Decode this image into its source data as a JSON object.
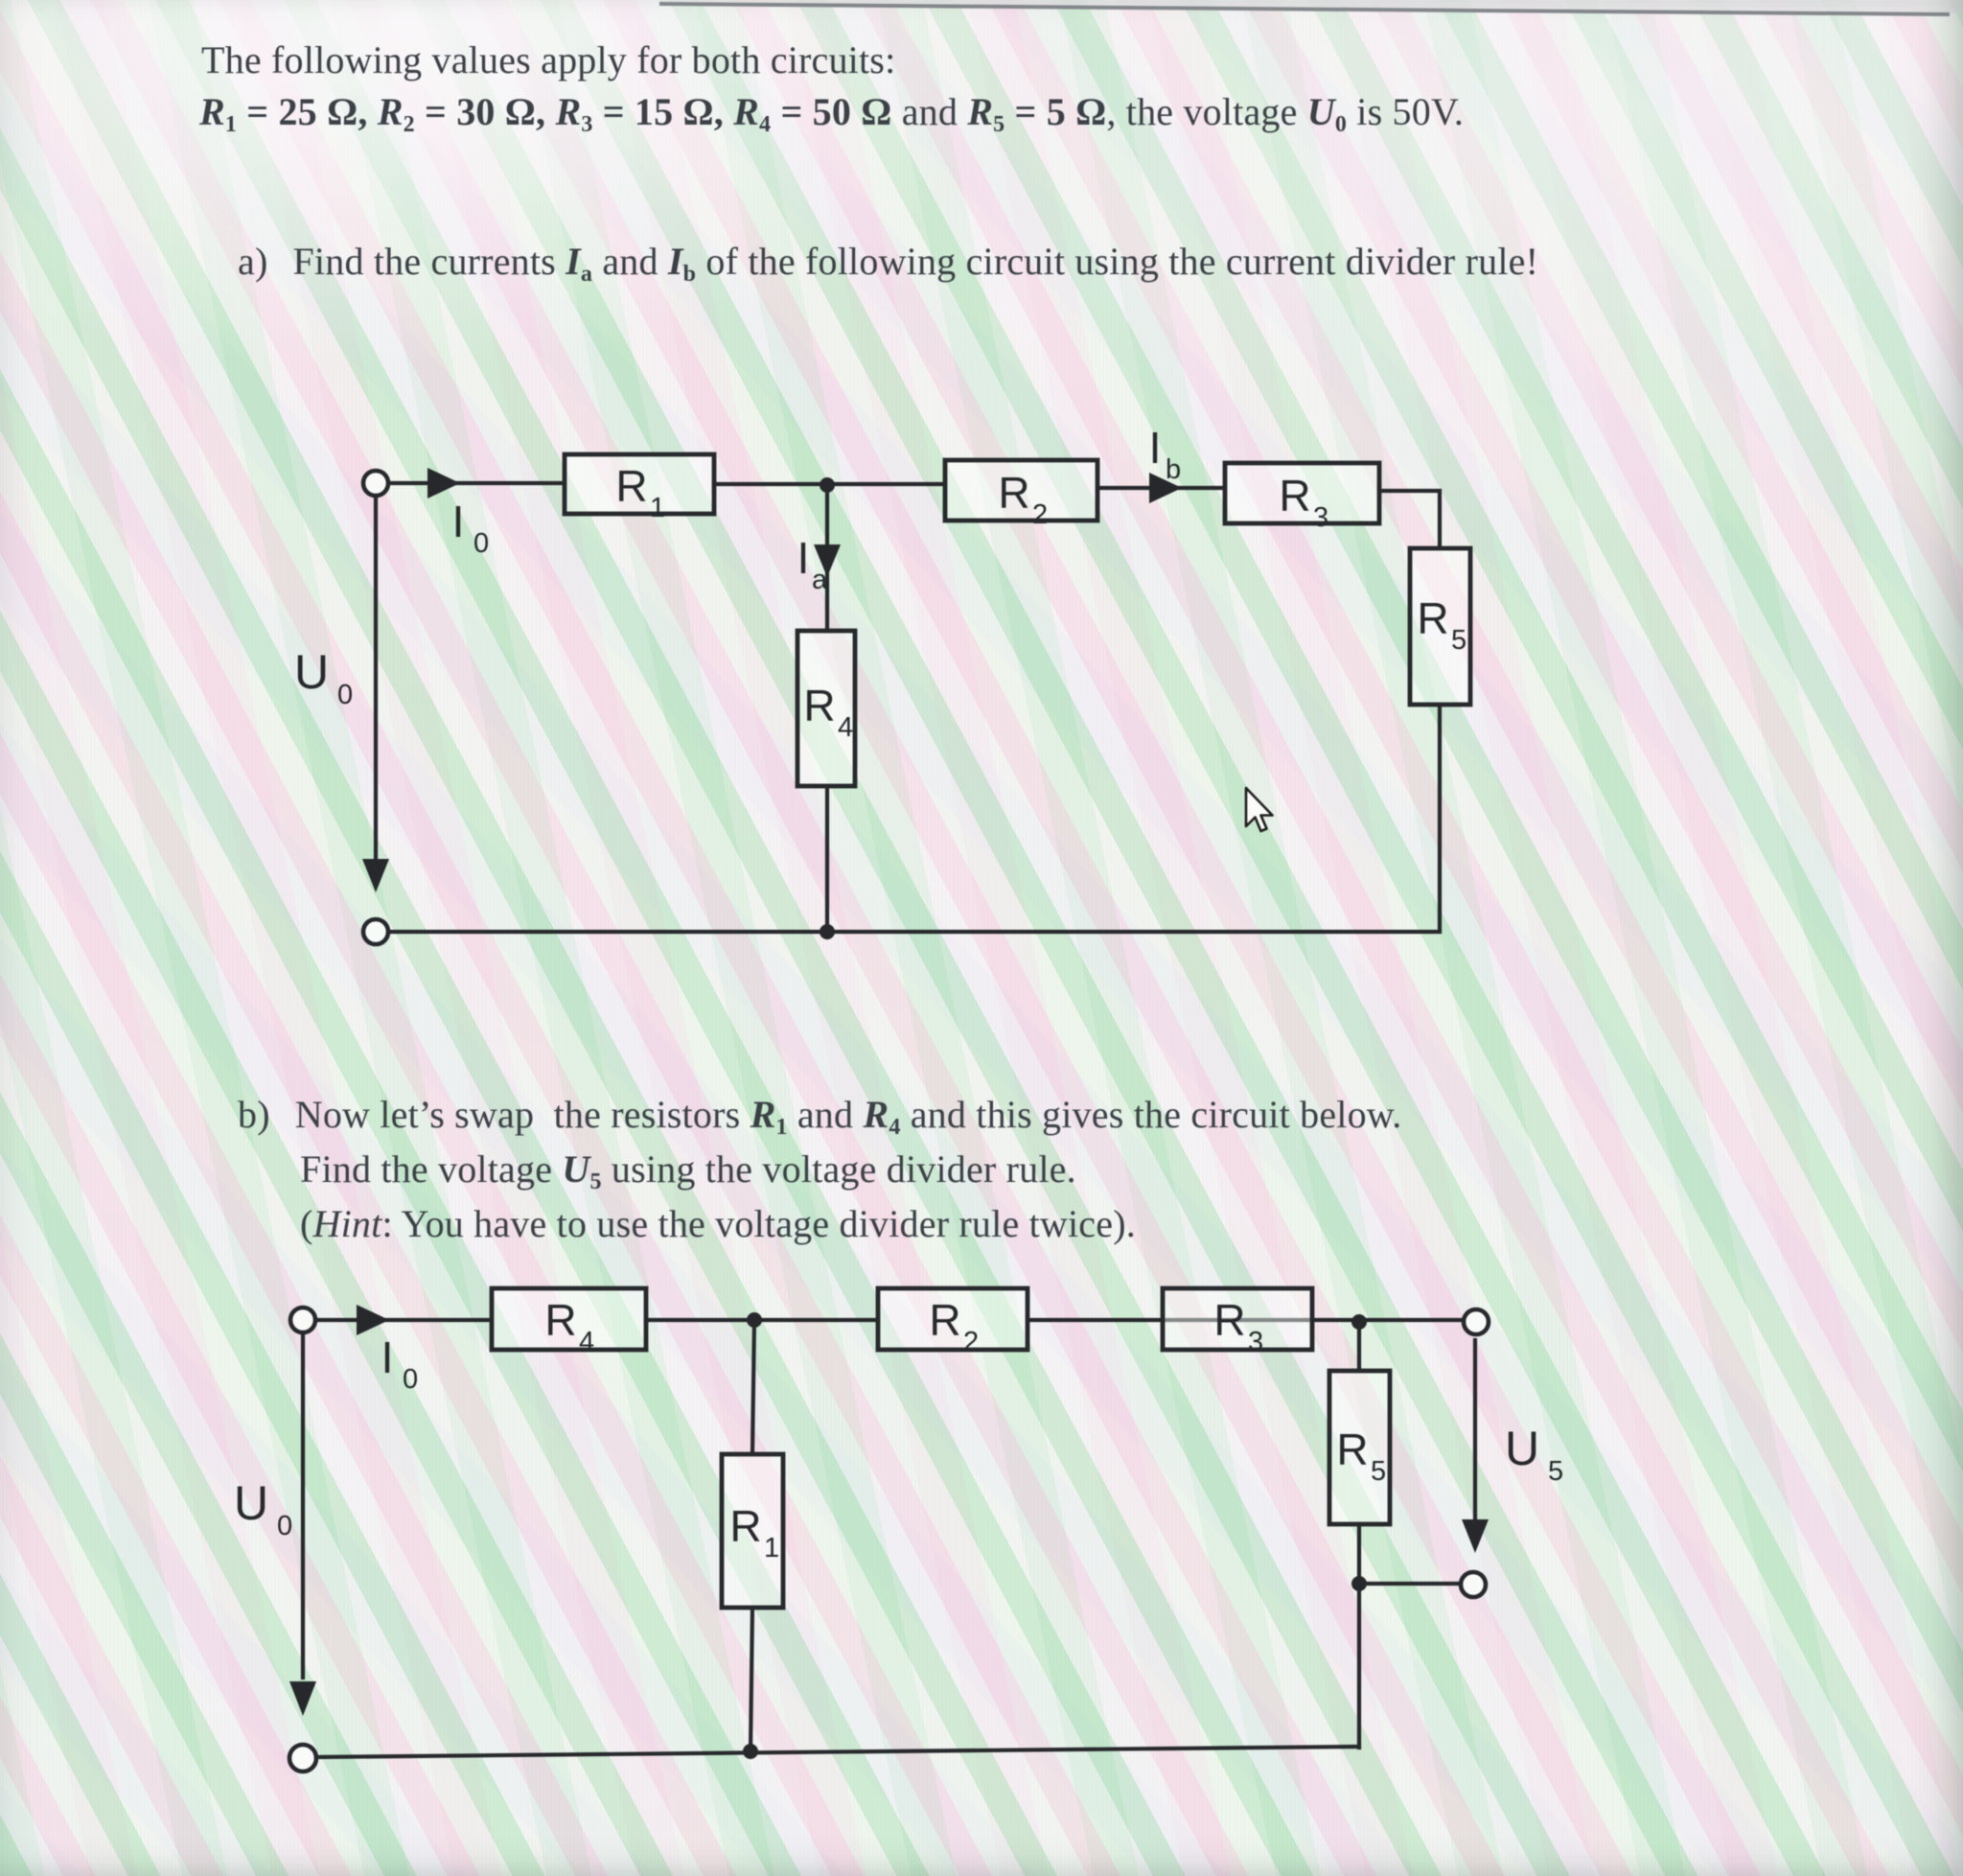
{
  "intro": {
    "line1": "The following values apply for both circuits:",
    "line2_segments": [
      {
        "t": "R",
        "c": "mvar"
      },
      {
        "t": "1",
        "c": "msub"
      },
      {
        "t": " = 25 Ω, ",
        "c": "mval"
      },
      {
        "t": "R",
        "c": "mvar"
      },
      {
        "t": "2",
        "c": "msub"
      },
      {
        "t": " = 30 Ω, ",
        "c": "mval"
      },
      {
        "t": "R",
        "c": "mvar"
      },
      {
        "t": "3",
        "c": "msub"
      },
      {
        "t": " = 15 Ω, ",
        "c": "mval"
      },
      {
        "t": "R",
        "c": "mvar"
      },
      {
        "t": "4",
        "c": "msub"
      },
      {
        "t": " = 50 Ω ",
        "c": "mval"
      },
      {
        "t": "and ",
        "c": "plain"
      },
      {
        "t": "R",
        "c": "mvar"
      },
      {
        "t": "5",
        "c": "msub"
      },
      {
        "t": " = 5 Ω",
        "c": "mval"
      },
      {
        "t": ", the voltage ",
        "c": "plain"
      },
      {
        "t": "U",
        "c": "mvar"
      },
      {
        "t": "0",
        "c": "msub"
      },
      {
        "t": " is 50V.",
        "c": "plain"
      }
    ]
  },
  "part_a": {
    "label": "a)",
    "segments": [
      {
        "t": "Find the currents ",
        "c": "plain"
      },
      {
        "t": "I",
        "c": "mvar"
      },
      {
        "t": "a",
        "c": "msub"
      },
      {
        "t": " and ",
        "c": "plain"
      },
      {
        "t": "I",
        "c": "mvar"
      },
      {
        "t": "b",
        "c": "msub"
      },
      {
        "t": " of the following circuit using the current divider rule!",
        "c": "plain"
      }
    ]
  },
  "part_b": {
    "label": "b)",
    "line1_segments": [
      {
        "t": "Now let’s swap  the resistors ",
        "c": "plain"
      },
      {
        "t": "R",
        "c": "mvar"
      },
      {
        "t": "1",
        "c": "msub"
      },
      {
        "t": " and ",
        "c": "plain"
      },
      {
        "t": "R",
        "c": "mvar"
      },
      {
        "t": "4",
        "c": "msub"
      },
      {
        "t": " and this gives the circuit below.",
        "c": "plain"
      }
    ],
    "line2_segments": [
      {
        "t": "Find the voltage ",
        "c": "plain"
      },
      {
        "t": "U",
        "c": "mvar"
      },
      {
        "t": "5",
        "c": "msub"
      },
      {
        "t": " using the voltage divider rule.",
        "c": "plain"
      }
    ],
    "line3_segments": [
      {
        "t": "(",
        "c": "plain"
      },
      {
        "t": "Hint",
        "c": "it"
      },
      {
        "t": ": You have to use the voltage divider rule twice).",
        "c": "plain"
      }
    ]
  },
  "circuit_a": {
    "source": {
      "main": "U",
      "sub": "0"
    },
    "input_current": {
      "main": "I",
      "sub": "0"
    },
    "current_a": {
      "main": "I",
      "sub": "a"
    },
    "current_b": {
      "main": "I",
      "sub": "b"
    },
    "r1": {
      "main": "R",
      "sub": "1"
    },
    "r2": {
      "main": "R",
      "sub": "2"
    },
    "r3": {
      "main": "R",
      "sub": "3"
    },
    "r4": {
      "main": "R",
      "sub": "4"
    },
    "r5": {
      "main": "R",
      "sub": "5"
    }
  },
  "circuit_b": {
    "source": {
      "main": "U",
      "sub": "0"
    },
    "input_current": {
      "main": "I",
      "sub": "0"
    },
    "output_voltage": {
      "main": "U",
      "sub": "5"
    },
    "r1": {
      "main": "R",
      "sub": "1"
    },
    "r2": {
      "main": "R",
      "sub": "2"
    },
    "r3": {
      "main": "R",
      "sub": "3"
    },
    "r4": {
      "main": "R",
      "sub": "4"
    },
    "r5": {
      "main": "R",
      "sub": "5"
    }
  },
  "colors": {
    "ink": "#26282b",
    "text": "#3b4046",
    "screen_edge_line": "#85888c"
  }
}
